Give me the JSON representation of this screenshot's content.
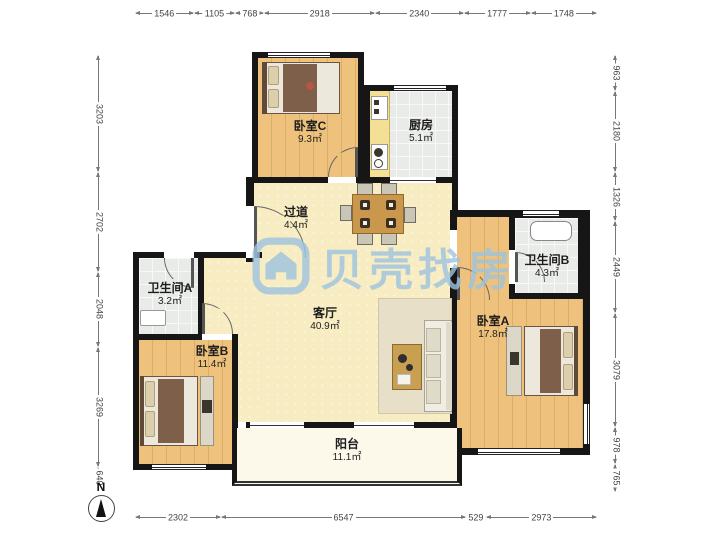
{
  "watermark": {
    "text": "贝壳找房"
  },
  "compass": {
    "label": "N"
  },
  "rulers": {
    "top": [
      "1546",
      "1105",
      "768",
      "2918",
      "2340",
      "1777",
      "1748"
    ],
    "bottom": [
      "2302",
      "6547",
      "529",
      "2973"
    ],
    "left": [
      "3203",
      "2702",
      "2048",
      "3269",
      "640"
    ],
    "right": [
      "963",
      "2180",
      "1326",
      "2449",
      "3079",
      "978",
      "765"
    ]
  },
  "rooms": {
    "bedroom_c": {
      "name": "卧室C",
      "area": "9.3㎡"
    },
    "kitchen": {
      "name": "厨房",
      "area": "5.1㎡"
    },
    "hallway": {
      "name": "过道",
      "area": "4.4㎡"
    },
    "bathroom_a": {
      "name": "卫生间A",
      "area": "3.2㎡"
    },
    "bathroom_b": {
      "name": "卫生间B",
      "area": "4.3㎡"
    },
    "bedroom_b": {
      "name": "卧室B",
      "area": "11.4㎡"
    },
    "living_room": {
      "name": "客厅",
      "area": "40.9㎡"
    },
    "bedroom_a": {
      "name": "卧室A",
      "area": "17.8㎡"
    },
    "balcony": {
      "name": "阳台",
      "area": "11.1㎡"
    }
  },
  "colors": {
    "wall": "#161616",
    "wood_floor": "#eec27d",
    "cream_floor": "#f7ecc2",
    "tile_floor": "#e9ebe8",
    "watermark_blue": "#9ec4e0"
  }
}
